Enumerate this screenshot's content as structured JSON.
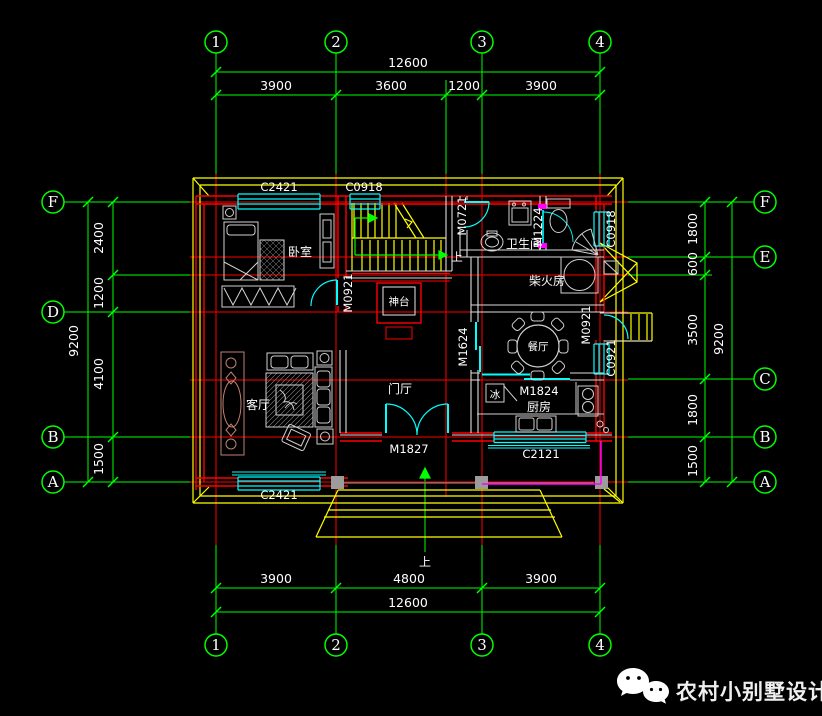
{
  "colors": {
    "background": "#000000",
    "grid_green": "#00ff00",
    "wall_red": "#ff0000",
    "window_cyan": "#00ffff",
    "eave_yellow": "#ffff00",
    "text_white": "#ffffff",
    "furniture_gray": "#d0d0d0",
    "railing_magenta": "#ff00ff",
    "decor_brown": "#c08070",
    "column_gray": "#9c9c9c"
  },
  "axes": {
    "top": [
      "1",
      "2",
      "3",
      "4"
    ],
    "bottom": [
      "1",
      "2",
      "3",
      "4"
    ],
    "left": [
      "F",
      "D",
      "B",
      "A"
    ],
    "right": [
      "F",
      "E",
      "C",
      "B",
      "A"
    ]
  },
  "dims": {
    "top_total": "12600",
    "top_segments": [
      "3900",
      "3600",
      "1200",
      "3900"
    ],
    "bottom_total": "12600",
    "bottom_segments": [
      "3900",
      "4800",
      "3900"
    ],
    "left_total": "9200",
    "left_segments": [
      "2400",
      "1200",
      "4100",
      "1500"
    ],
    "right_total": "9200",
    "right_segments": [
      "1800",
      "600",
      "3500",
      "1800",
      "1500"
    ]
  },
  "rooms": {
    "bedroom": "卧室",
    "living": "客厅",
    "foyer": "门厅",
    "dining": "餐厅",
    "kitchen": "厨房",
    "bathroom": "卫生间",
    "firewood": "柴火房",
    "altar": "神台",
    "fridge": "冰"
  },
  "openings": {
    "c2421_top": "C2421",
    "c0918_top": "C0918",
    "m0721": "M0721",
    "m1224": "M1224",
    "c0918_right": "C0918",
    "m0921_bedroom": "M0921",
    "m1624": "M1624",
    "m0921_right": "M0921",
    "c0921": "C0921",
    "m1827": "M1827",
    "c2121": "C2121",
    "m1824": "M1824",
    "c2421_bottom": "C2421"
  },
  "annotations": {
    "up_stair": "上",
    "up_entry": "上"
  },
  "brand": {
    "name": "农村小别墅设计"
  }
}
